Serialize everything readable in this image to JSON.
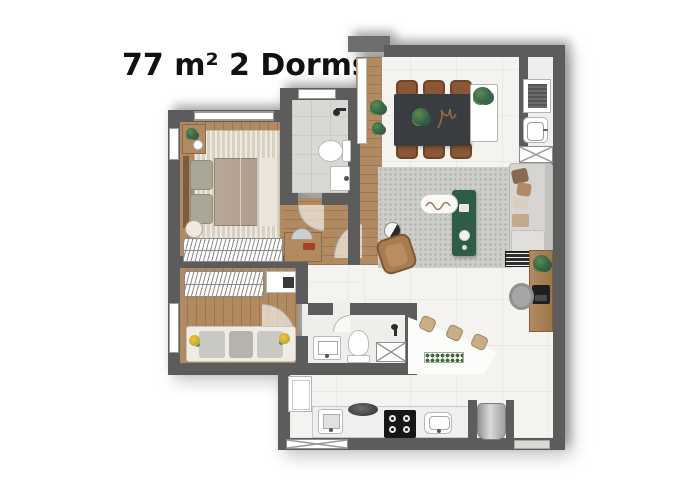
{
  "title": "77 m² 2 Dorms",
  "palette": {
    "wall": "#5c5c5c",
    "wallLight": "#6e6e6e",
    "wood": "#b28a62",
    "woodDeep": "#7a5c3f",
    "marble": "#f4f3f0",
    "laundryFloor": "#edefee",
    "tile": "#d8d8d5",
    "bathFloor": "#efeeea",
    "rugBeige": "#d9d1c0",
    "rugGray": "#cdcdc9",
    "bedTaupe": "#b1a191",
    "pillowSage": "#a9a896",
    "counter": "#eef0ef",
    "dark": "#1e1e1e",
    "steel": "#b9bcbc",
    "tableDark": "#3a3d3f",
    "chairBrown": "#8a5837",
    "armchairBrown": "#a87c4f",
    "sofaGray": "#d6d5d1",
    "greenDeep": "#2f5c44",
    "greenLeaf": "#5a8a52",
    "stoolTan": "#c7ae86",
    "cooktopBlack": "#161616"
  }
}
